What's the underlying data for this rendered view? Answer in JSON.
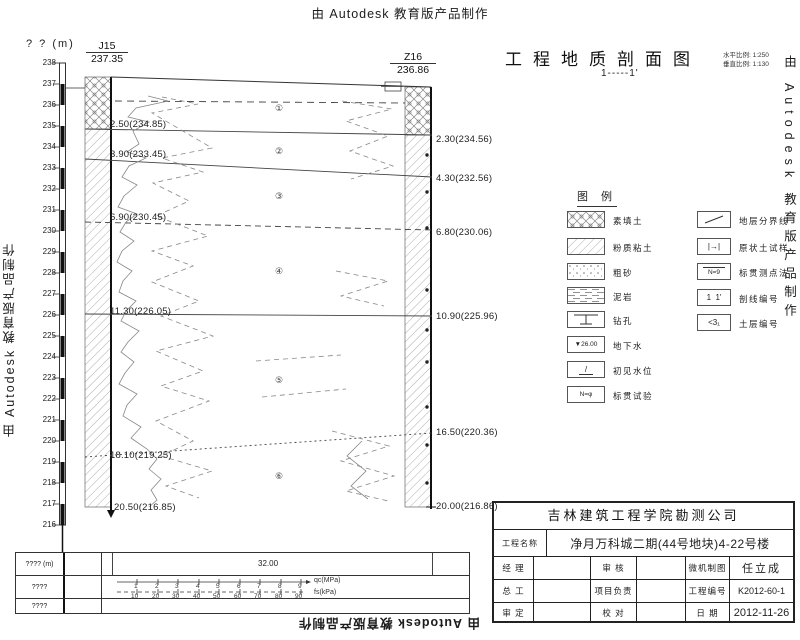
{
  "watermarks": {
    "top": "由 Autodesk 教育版产品制作",
    "bottom": "由 Autodesk 教育版产品制作",
    "left": "由 Autodesk 教育版产品制作",
    "right": "由 Autodesk 教育版产品制作"
  },
  "header": {
    "title": "工程地质剖面图",
    "scale_h": "水平比例: 1:250",
    "scale_v": "垂直比例: 1:130",
    "section_no": "1-----1'"
  },
  "axis": {
    "unit_label": "? ? (m)",
    "ticks": [
      "238",
      "237",
      "236",
      "235",
      "234",
      "233",
      "232",
      "231",
      "230",
      "229",
      "228",
      "227",
      "226",
      "225",
      "224",
      "223",
      "222",
      "221",
      "220",
      "219",
      "218",
      "217",
      "216"
    ]
  },
  "borehole_left": {
    "id": "J15",
    "top_elevation": "237.35",
    "depth_marks": [
      "2.50(234.85)",
      "3.90(233.45)",
      "6.90(230.45)",
      "11.30(226.05)",
      "18.10(219.25)",
      "20.50(216.85)"
    ]
  },
  "borehole_right": {
    "id": "Z16",
    "top_elevation": "236.86",
    "depth_marks": [
      "2.30(234.56)",
      "4.30(232.56)",
      "6.80(230.06)",
      "10.90(225.96)",
      "16.50(220.36)",
      "20.00(216.86)"
    ]
  },
  "layer_numbers": [
    "①",
    "②",
    "③",
    "④",
    "⑤",
    "⑥"
  ],
  "legend": {
    "title": "图 例",
    "items_left": [
      {
        "name": "素填土"
      },
      {
        "name": "粉质粘土"
      },
      {
        "name": "粗砂"
      },
      {
        "name": "泥岩"
      },
      {
        "name": "钻孔"
      },
      {
        "name": "地下水",
        "symbol": "▼26.00"
      },
      {
        "name": "初见水位",
        "symbol": "/"
      },
      {
        "name": "标贯试验",
        "symbol": "N=φ"
      }
    ],
    "items_right": [
      {
        "name": "地层分界线"
      },
      {
        "name": "原状土试样",
        "symbol": "|→|"
      },
      {
        "name": "标贯测点法",
        "symbol": "N=9"
      },
      {
        "name": "剖线编号",
        "symbol": "1  1'"
      },
      {
        "name": "土层编号",
        "symbol": "<3₁"
      }
    ]
  },
  "title_block": {
    "company": "吉林建筑工程学院勘测公司",
    "project_label": "工程名称",
    "project_name": "净月万科城二期(44号地块)4-22号楼",
    "rows": [
      {
        "l1": "经 理",
        "v1": "",
        "l2": "审 核",
        "v2": "",
        "l3": "微机制图",
        "v3": "任立成"
      },
      {
        "l1": "总 工",
        "v1": "",
        "l2": "项目负责",
        "v2": "",
        "l3": "工程编号",
        "v3": "K2012-60-1"
      },
      {
        "l1": "审 定",
        "v1": "",
        "l2": "校 对",
        "v2": "",
        "l3": "日 期",
        "v3": "2012-11-26"
      }
    ]
  },
  "bottom_table": {
    "row1_label": "???? (m)",
    "row2_label": "????",
    "row3_label": "????",
    "spacing_value": "32.00",
    "scale_qc": {
      "ticks": [
        "1",
        "2",
        "3",
        "4",
        "5",
        "6",
        "7",
        "8",
        "9"
      ],
      "label": "qc(MPa)"
    },
    "scale_fs": {
      "ticks": [
        "10",
        "20",
        "30",
        "40",
        "50",
        "60",
        "70",
        "80",
        "90"
      ],
      "label": "fs(kPa)"
    }
  }
}
